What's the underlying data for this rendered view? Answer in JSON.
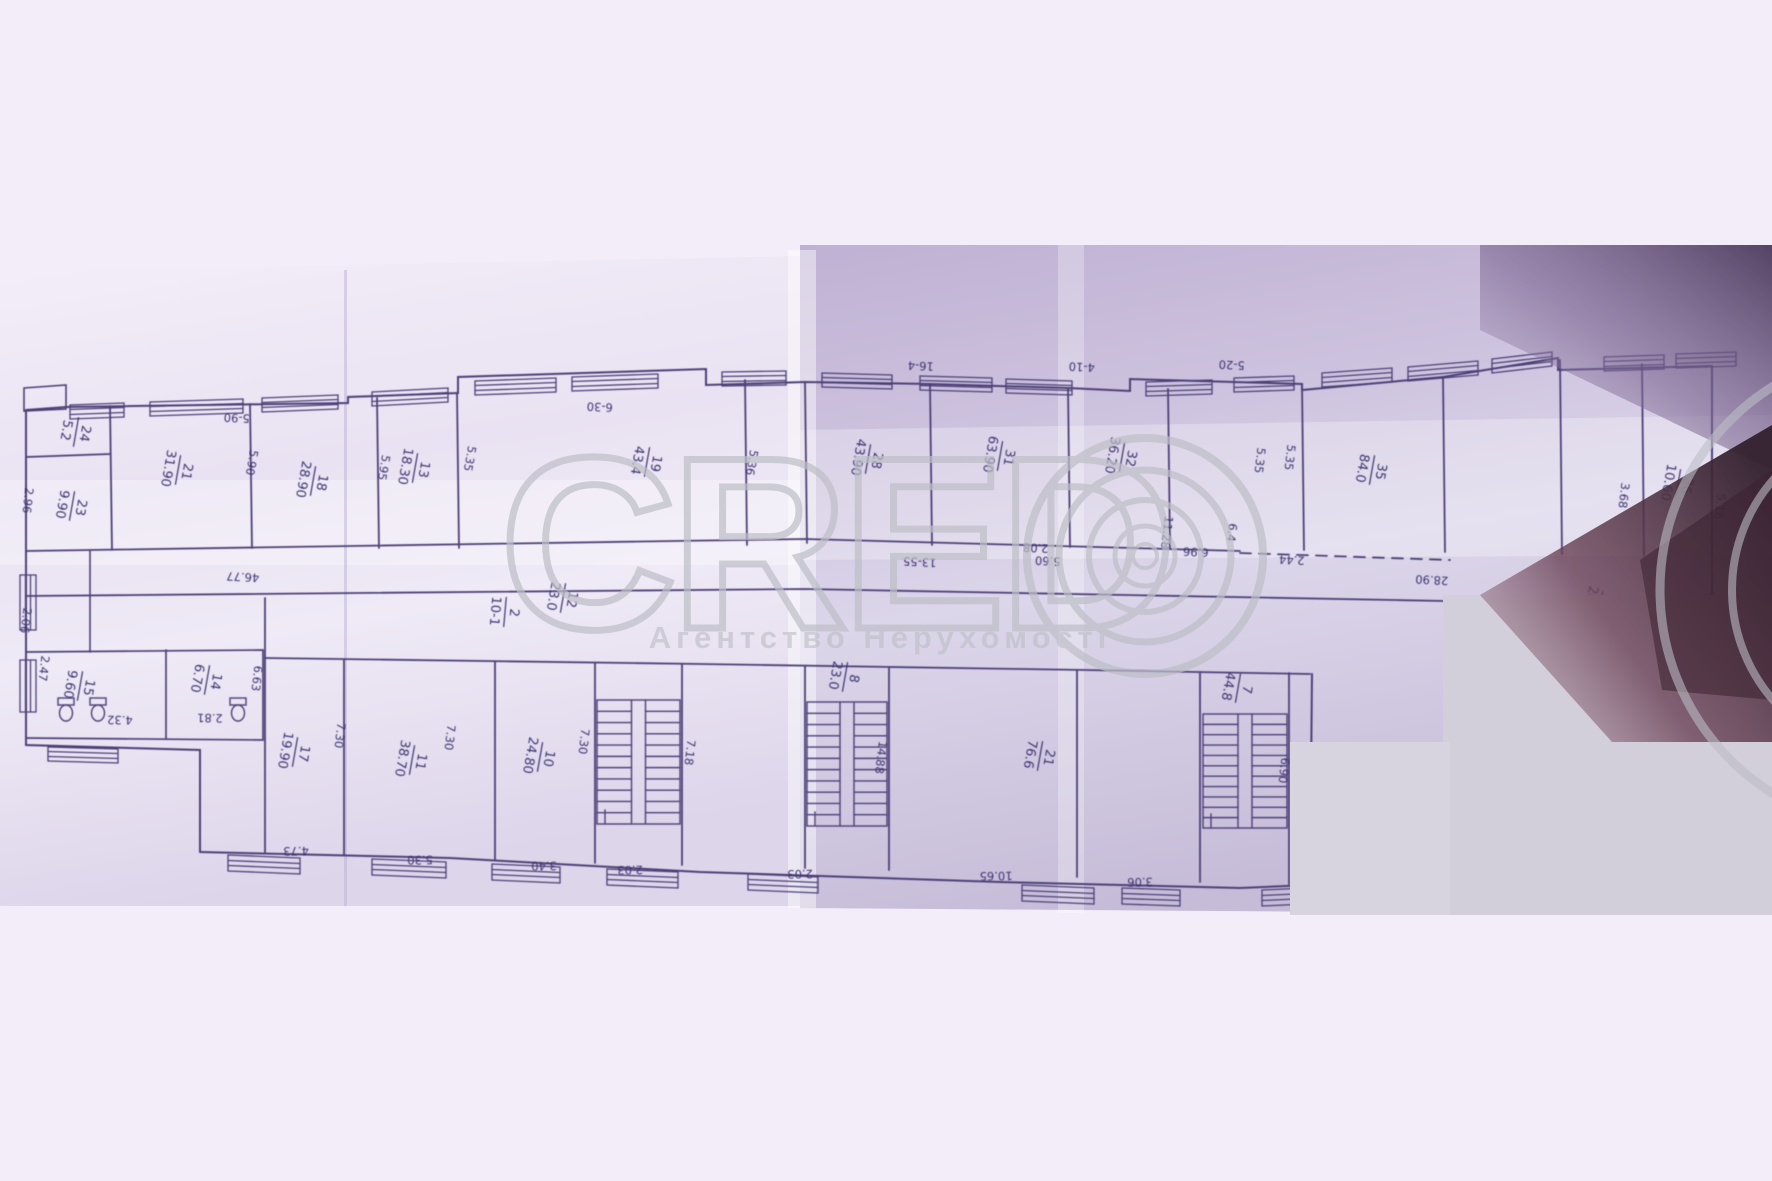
{
  "watermark": {
    "brand": "CRED",
    "subtitle": "Агентство Нерухомості",
    "color": "#bcbec6"
  },
  "plan": {
    "line_color": "#4d4178",
    "label_color": "#3d3470",
    "room_labels": [
      {
        "num": "24",
        "area": "5.2"
      },
      {
        "num": "23",
        "area": "9.90"
      },
      {
        "num": "21",
        "area": "31.90"
      },
      {
        "num": "18",
        "area": "28.90"
      },
      {
        "num": "13",
        "area": "18.30"
      },
      {
        "num": "19",
        "area": "43.4"
      },
      {
        "num": "28",
        "area": "43.90"
      },
      {
        "num": "31",
        "area": "63.90"
      },
      {
        "num": "32",
        "area": "36.20"
      },
      {
        "num": "35",
        "area": "84.0"
      },
      {
        "num": "36",
        "area": "10.60"
      },
      {
        "num": "7",
        "area": "28.90"
      },
      {
        "num": "2",
        "area": "10-1"
      },
      {
        "num": "15",
        "area": "9.60"
      },
      {
        "num": "14",
        "area": "6.70"
      },
      {
        "num": "17",
        "area": "19.90"
      },
      {
        "num": "11",
        "area": "38.70"
      },
      {
        "num": "10",
        "area": "24.80"
      },
      {
        "num": "12",
        "area": "23.0"
      },
      {
        "num": "8",
        "area": "23.0"
      },
      {
        "num": "21",
        "area": "76.6"
      },
      {
        "num": "7",
        "area": "44.8"
      }
    ],
    "dim_labels": [
      "5-90",
      "6-30",
      "16-4",
      "4-10",
      "5-20",
      "2.96",
      "5.90",
      "5.95",
      "5.35",
      "5.36",
      "5.35",
      "5.35",
      "46.77",
      "13-55",
      "2.08",
      "5.60",
      "11.28",
      "6.96",
      "6.4",
      "2.44",
      "2.06",
      "2.47",
      "6.63",
      "4.32",
      "2.81",
      "7.30",
      "7.30",
      "7.30",
      "7.18",
      "14.88",
      "6.90",
      "4.73",
      "5.30",
      "3.40",
      "2.03",
      "2.03",
      "10.65",
      "3.06",
      "3.68",
      "5.16",
      "28.90"
    ]
  },
  "scan": {
    "background": "#f2edf8",
    "paper_left": "#ece6f4",
    "paper_right": "#c9bedd",
    "shadow_purple": "#6e5a85",
    "shadow_maroon": "#472c3c",
    "blank_patch": "#d2cfda"
  }
}
